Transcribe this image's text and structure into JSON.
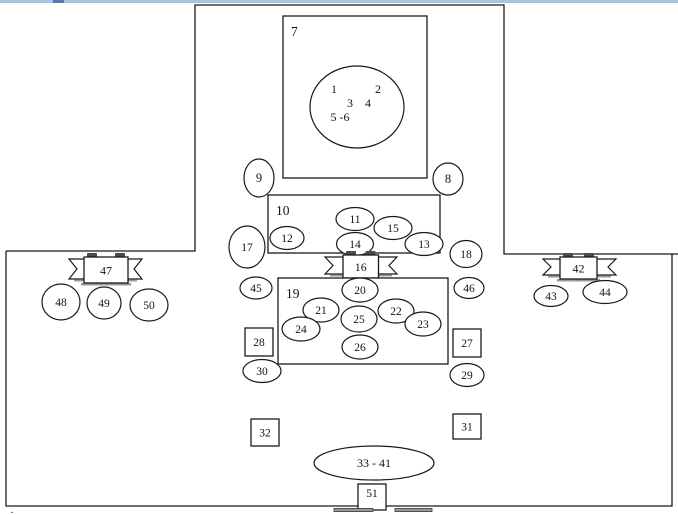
{
  "window": {
    "top_bar_color": "#a9c4e1",
    "top_bar_accent_color": "#4f7bae",
    "top_bar_accent_x": 53,
    "top_bar_accent_w": 11,
    "bottom_left_mark": "."
  },
  "diagram": {
    "stroke_color": "#1a1a1a",
    "shape_fill": "#ffffff",
    "text_color": "#141414",
    "ribbon_shadow_color": "#999999",
    "ribbon_tab_color": "#4a4a4a",
    "outline": {
      "paths": [
        {
          "id": "outline-top",
          "d": "M6,251 L195,251 L195,5 L504,5 L504,254 L678,254"
        },
        {
          "id": "outline-bottom",
          "d": "M6,251 L6,506 L672,506 L672,254"
        }
      ]
    },
    "annotations": [
      {
        "id": "pos-1",
        "label": "1",
        "x": 334,
        "y": 93
      },
      {
        "id": "pos-2",
        "label": "2",
        "x": 378,
        "y": 93
      },
      {
        "id": "pos-3",
        "label": "3",
        "x": 350,
        "y": 107
      },
      {
        "id": "pos-4",
        "label": "4",
        "x": 368,
        "y": 107
      },
      {
        "id": "pos-5-6",
        "label": "5 -6",
        "x": 340,
        "y": 121
      }
    ],
    "shapes": [
      {
        "type": "rect",
        "id": "7",
        "label": "7",
        "x": 283,
        "y": 16,
        "w": 144,
        "h": 162,
        "anchor": "topleft",
        "fs": 13.5
      },
      {
        "type": "ellipse",
        "id": "head-circle",
        "label": "",
        "cx": 357,
        "cy": 107,
        "rx": 47,
        "ry": 41
      },
      {
        "type": "ellipse",
        "id": "9",
        "label": "9",
        "cx": 259,
        "cy": 178,
        "rx": 15,
        "ry": 19,
        "fs": 12.5
      },
      {
        "type": "ellipse",
        "id": "8",
        "label": "8",
        "cx": 448,
        "cy": 179,
        "rx": 15,
        "ry": 16,
        "fs": 12.5
      },
      {
        "type": "rect",
        "id": "10",
        "label": "10",
        "x": 268,
        "y": 195,
        "w": 172,
        "h": 58,
        "anchor": "topleft",
        "fs": 13.5
      },
      {
        "type": "ellipse",
        "id": "11",
        "label": "11",
        "cx": 355,
        "cy": 219,
        "rx": 19,
        "ry": 11.5
      },
      {
        "type": "ellipse",
        "id": "15",
        "label": "15",
        "cx": 393,
        "cy": 228,
        "rx": 19,
        "ry": 11.5
      },
      {
        "type": "ellipse",
        "id": "12",
        "label": "12",
        "cx": 287,
        "cy": 238,
        "rx": 17,
        "ry": 11.5
      },
      {
        "type": "ellipse",
        "id": "14",
        "label": "14",
        "cx": 355,
        "cy": 244,
        "rx": 18.5,
        "ry": 11.5
      },
      {
        "type": "ellipse",
        "id": "13",
        "label": "13",
        "cx": 424,
        "cy": 244,
        "rx": 19,
        "ry": 11.5
      },
      {
        "type": "ellipse",
        "id": "17",
        "label": "17",
        "cx": 247,
        "cy": 247,
        "rx": 18,
        "ry": 21
      },
      {
        "type": "ellipse",
        "id": "18",
        "label": "18",
        "cx": 466,
        "cy": 254,
        "rx": 16,
        "ry": 13.5
      },
      {
        "type": "ribbon",
        "id": "16",
        "label": "16",
        "x": 343,
        "y": 255,
        "w": 35.5,
        "h": 23,
        "sx": 325,
        "ex": 397
      },
      {
        "type": "ellipse",
        "id": "45",
        "label": "45",
        "cx": 256,
        "cy": 288,
        "rx": 16,
        "ry": 11
      },
      {
        "type": "ellipse",
        "id": "46",
        "label": "46",
        "cx": 469,
        "cy": 288,
        "rx": 15,
        "ry": 10.5
      },
      {
        "type": "rect",
        "id": "19",
        "label": "19",
        "x": 278,
        "y": 278,
        "w": 170,
        "h": 86,
        "anchor": "topleft",
        "fs": 13.5
      },
      {
        "type": "ellipse",
        "id": "20",
        "label": "20",
        "cx": 360,
        "cy": 290,
        "rx": 18,
        "ry": 12
      },
      {
        "type": "ellipse",
        "id": "21",
        "label": "21",
        "cx": 321,
        "cy": 310,
        "rx": 18,
        "ry": 12
      },
      {
        "type": "ellipse",
        "id": "22",
        "label": "22",
        "cx": 396,
        "cy": 311,
        "rx": 18,
        "ry": 12
      },
      {
        "type": "ellipse",
        "id": "25",
        "label": "25",
        "cx": 359,
        "cy": 319,
        "rx": 18,
        "ry": 13
      },
      {
        "type": "ellipse",
        "id": "24",
        "label": "24",
        "cx": 301,
        "cy": 329,
        "rx": 19,
        "ry": 12
      },
      {
        "type": "ellipse",
        "id": "23",
        "label": "23",
        "cx": 423,
        "cy": 324,
        "rx": 18,
        "ry": 12
      },
      {
        "type": "ellipse",
        "id": "26",
        "label": "26",
        "cx": 360,
        "cy": 347,
        "rx": 18,
        "ry": 12
      },
      {
        "type": "rect",
        "id": "28",
        "label": "28",
        "x": 245,
        "y": 328,
        "w": 28,
        "h": 28,
        "anchor": "center"
      },
      {
        "type": "rect",
        "id": "27",
        "label": "27",
        "x": 453,
        "y": 329,
        "w": 28,
        "h": 28,
        "anchor": "center"
      },
      {
        "type": "ellipse",
        "id": "30",
        "label": "30",
        "cx": 262,
        "cy": 371,
        "rx": 19,
        "ry": 11.5
      },
      {
        "type": "ellipse",
        "id": "29",
        "label": "29",
        "cx": 467,
        "cy": 375,
        "rx": 17,
        "ry": 11.5
      },
      {
        "type": "rect",
        "id": "32",
        "label": "32",
        "x": 251,
        "y": 419,
        "w": 28,
        "h": 27,
        "anchor": "center"
      },
      {
        "type": "rect",
        "id": "31",
        "label": "31",
        "x": 453,
        "y": 414,
        "w": 28,
        "h": 25,
        "anchor": "center"
      },
      {
        "type": "ribbon",
        "id": "47",
        "label": "47",
        "x": 84,
        "y": 257,
        "w": 44,
        "h": 26,
        "sx": 69,
        "ex": 142
      },
      {
        "type": "ellipse",
        "id": "48",
        "label": "48",
        "cx": 61,
        "cy": 302,
        "rx": 19,
        "ry": 18
      },
      {
        "type": "ellipse",
        "id": "49",
        "label": "49",
        "cx": 104,
        "cy": 303,
        "rx": 17,
        "ry": 16
      },
      {
        "type": "ellipse",
        "id": "50",
        "label": "50",
        "cx": 149,
        "cy": 305,
        "rx": 19,
        "ry": 16
      },
      {
        "type": "ribbon",
        "id": "42",
        "label": "42",
        "x": 560,
        "y": 257,
        "w": 37,
        "h": 22,
        "sx": 543,
        "ex": 616
      },
      {
        "type": "ellipse",
        "id": "43",
        "label": "43",
        "cx": 551,
        "cy": 296,
        "rx": 17,
        "ry": 10.5
      },
      {
        "type": "ellipse",
        "id": "44",
        "label": "44",
        "cx": 605,
        "cy": 292,
        "rx": 22,
        "ry": 11.5
      },
      {
        "type": "ellipse",
        "id": "33-41",
        "label": "33 - 41",
        "cx": 374,
        "cy": 463,
        "rx": 60,
        "ry": 17,
        "fs": 12
      },
      {
        "type": "rect",
        "id": "51",
        "label": "51",
        "x": 358,
        "y": 484,
        "w": 28,
        "h": 26,
        "anchor": "top"
      },
      {
        "type": "bar",
        "id": "cutoff-bar-left",
        "label": "",
        "x": 334,
        "y": 508.5,
        "w": 39,
        "h": 3
      },
      {
        "type": "bar",
        "id": "cutoff-bar-right",
        "label": "",
        "x": 395,
        "y": 508.5,
        "w": 37,
        "h": 3
      }
    ]
  }
}
